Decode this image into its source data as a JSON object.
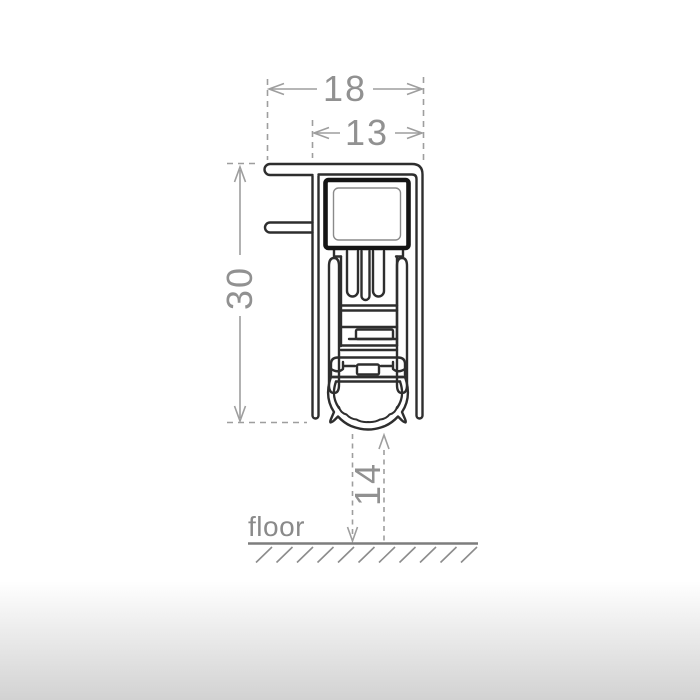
{
  "page": {
    "background_top": "#ffffff",
    "background_bottom": "#d2d2d2"
  },
  "drawing": {
    "dimensions": {
      "outer_width": "18",
      "inner_width": "13",
      "profile_height": "30",
      "floor_gap": "14"
    },
    "floor_label": "floor",
    "colors": {
      "profile_outline": "#2e2e2e",
      "heavy_outline": "#151515",
      "inner_detail": "#8a8a8a",
      "dimension_lines": "#9e9e9e",
      "dimension_text": "#919191",
      "floor_line": "#7d7d7d",
      "hatch": "#8c8c8c"
    }
  }
}
